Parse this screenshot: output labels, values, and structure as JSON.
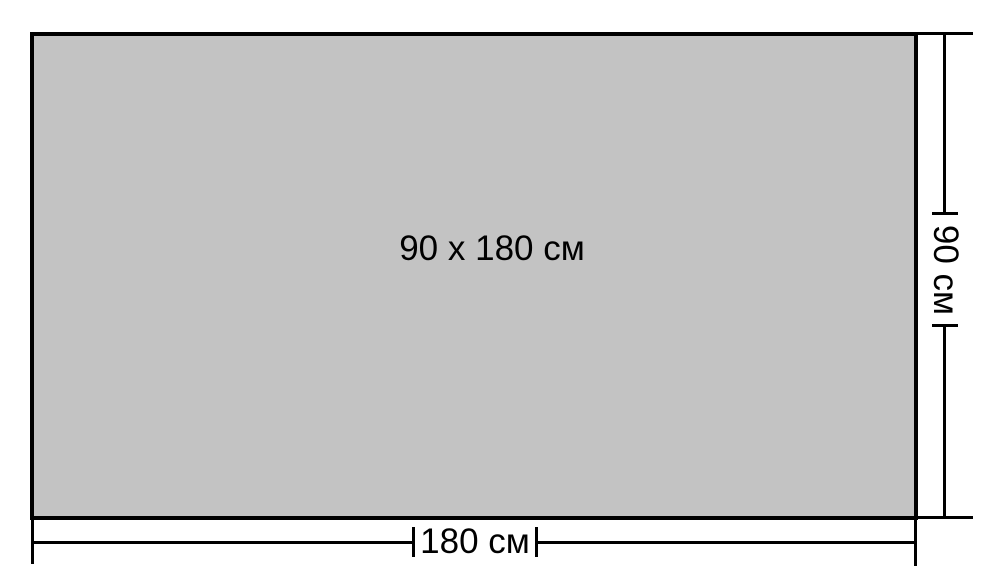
{
  "diagram": {
    "center_label": "90 x 180 см",
    "width_label": "180 см",
    "height_label": "90 см"
  },
  "colors": {
    "panel_fill": "#c3c3c3",
    "line": "#000000",
    "background": "#ffffff"
  }
}
